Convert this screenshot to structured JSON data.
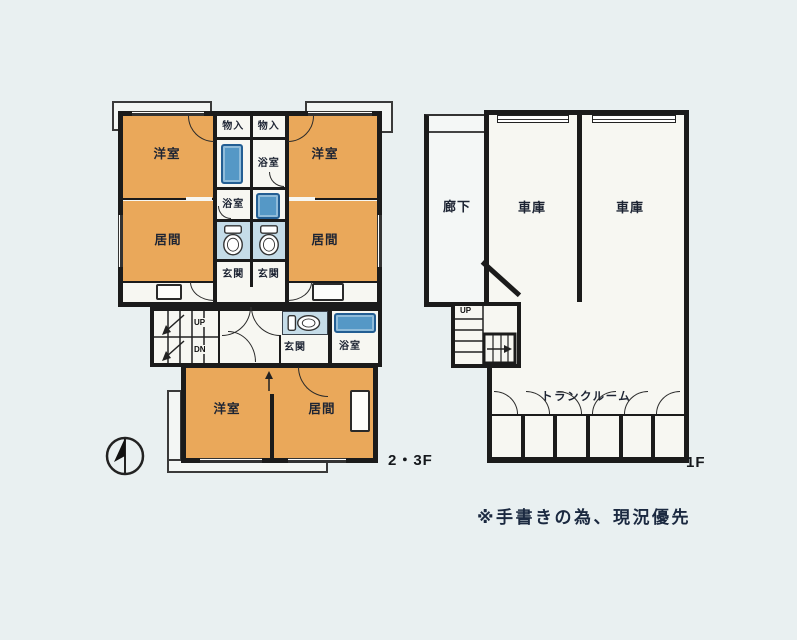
{
  "note": "※手書きの為、現況優先",
  "colors": {
    "background": "#E9F0F1",
    "wall": "#1B1B1B",
    "room_orange": "#EAA85A",
    "bathtub_blue": "#5598C6",
    "bathtub_border": "#235E93",
    "toilet_room_blue": "#C5DCE8",
    "floor_white": "#F7F7F2"
  },
  "plan_23f": {
    "floor_label": "2・3F",
    "labels": {
      "western_room": "洋室",
      "living_room": "居間",
      "bath": "浴室",
      "storage": "物入",
      "entrance": "玄関",
      "up": "UP",
      "down": "DN"
    }
  },
  "plan_1f": {
    "floor_label": "1F",
    "labels": {
      "corridor": "廊下",
      "garage": "車庫",
      "trunk_room": "トランクルーム",
      "up": "UP"
    }
  }
}
